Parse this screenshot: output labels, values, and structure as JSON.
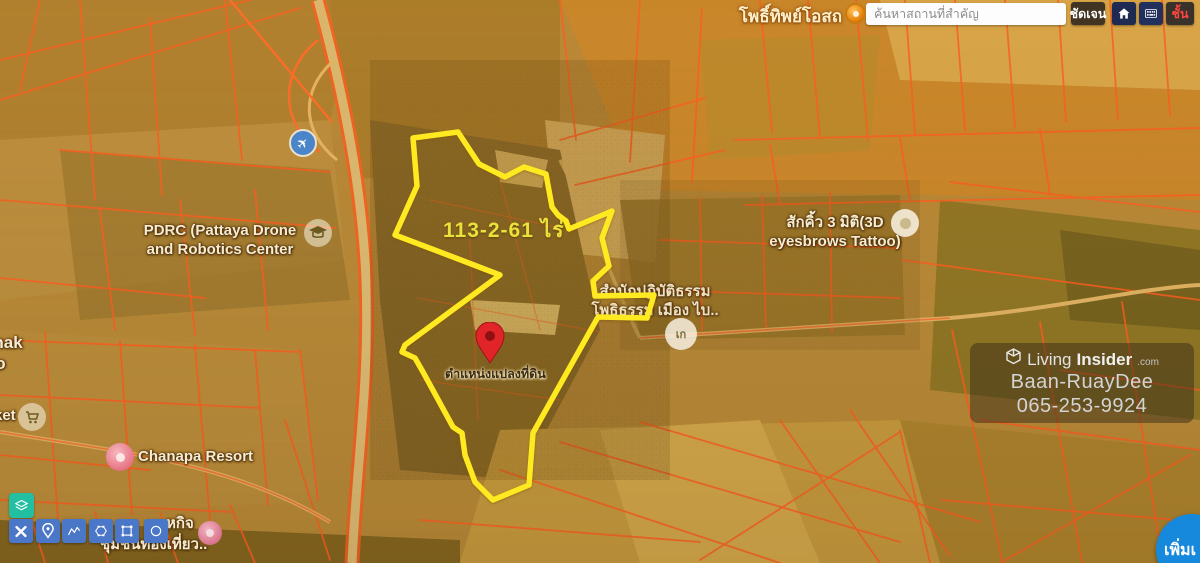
{
  "search_bar": {
    "map_label_left": "โพธิ์ทิพย์โอสถ",
    "input_placeholder": "ค้นหาสถานที่สำคัญ",
    "clear_button": "ชัดเจน",
    "layers_button": "ชั้น"
  },
  "map_labels": {
    "parcel_area": "113-2-61 ไร่",
    "pin_label": "ตำแหน่งแปลงที่ดิน",
    "pdrc_line1": "PDRC (Pattaya Drone",
    "pdrc_line2": "and Robotics Center",
    "tattoo_line1": "สักคิ้ว 3 มิติ(3D",
    "tattoo_line2": "eyesbrows Tattoo)",
    "temple_line1": "สำนักปฏิบัติธรรม",
    "temple_line2": "โพธิธรรม เมือง ไบ..",
    "poi_badge": "เก",
    "left_edge_line1": "g Chak",
    "left_edge_line2": "gaeo",
    "market_label": "ket",
    "resort_label": "Chanapa Resort",
    "community_line1": "หกิจ",
    "community_line2": "ชุมชนท่องเที่ยว.."
  },
  "watermark": {
    "brand_light": "Living",
    "brand_bold": "Insider",
    "brand_suffix": ".com",
    "line2": "Baan-RuayDee",
    "line3": "065-253-9924"
  },
  "buttons": {
    "add_parcel": "เพิ่มเ"
  },
  "colors": {
    "parcel_outline": "#ffe920",
    "cadastral_line": "#ff5a22",
    "draw_toolbar_blue": "#4b77c9",
    "layers_teal": "#23bfa2",
    "add_button_blue": "#1789dd",
    "pin_red": "#e02428",
    "area_label_yellow": "#e9e13c",
    "layers_button_text_red": "#ff4540"
  }
}
